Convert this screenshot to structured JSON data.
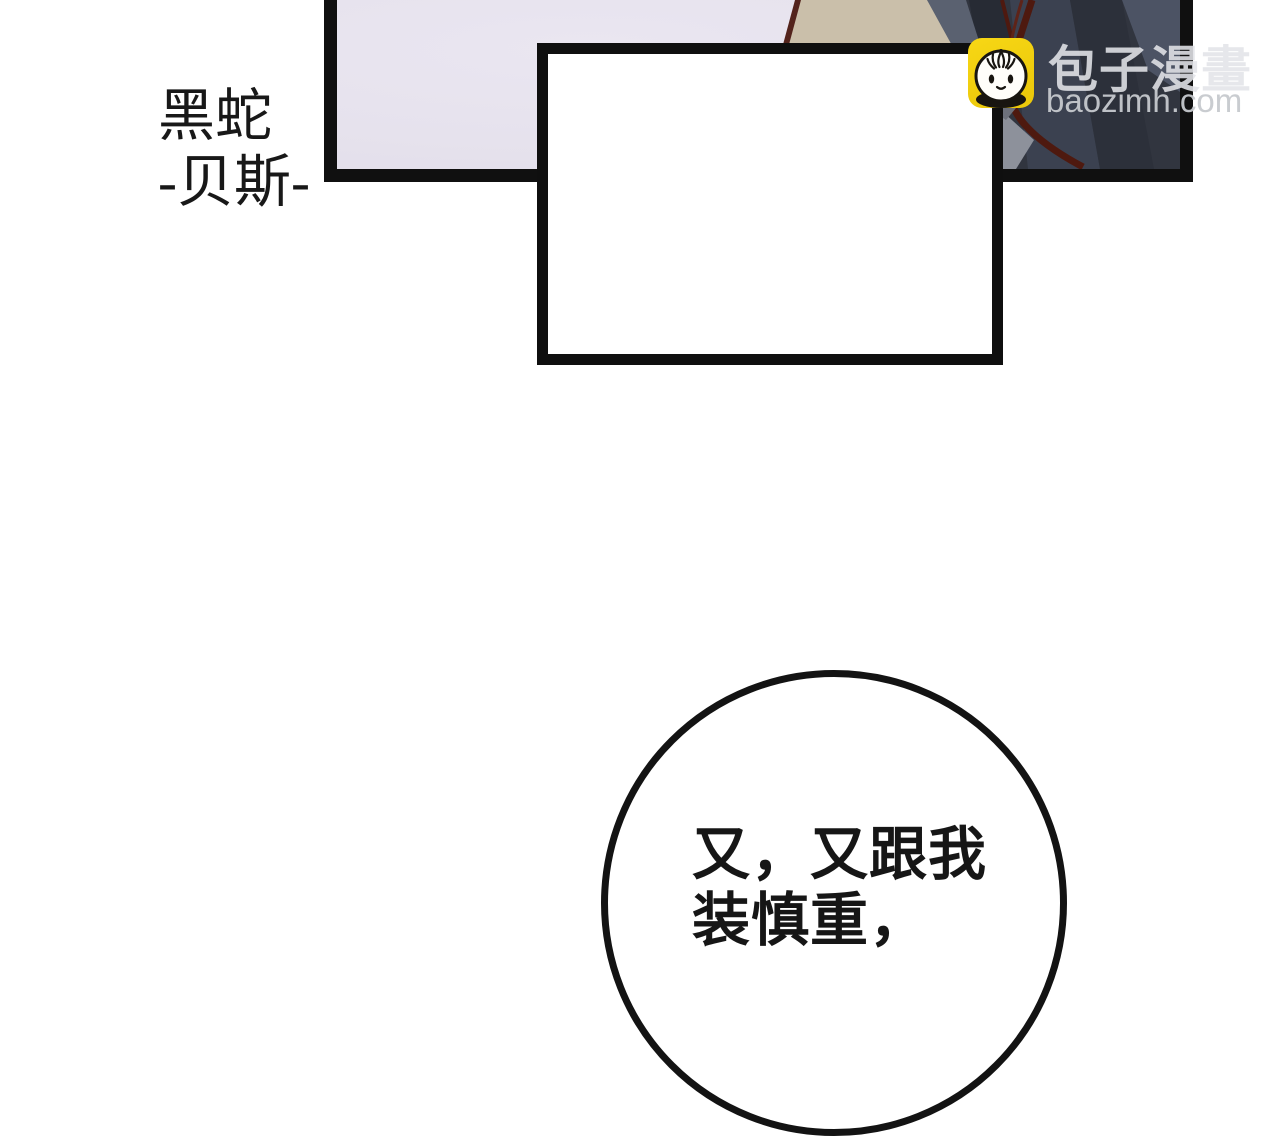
{
  "caption_box": {
    "line1": "黑蛇",
    "line2": "-贝斯-"
  },
  "watermark": {
    "logo_icon": "baozi-bun-icon",
    "brand": "包子漫畫",
    "domain": "baozimh.com"
  },
  "speech_bubble": {
    "line1": "又，又跟我",
    "line2": "装慎重，"
  },
  "colors": {
    "panel_background": "#e6e2ed",
    "panel_border": "#101010",
    "art_beige": "#cabfaa",
    "art_dark_slate": "#31353f",
    "art_maroon": "#4e190f",
    "logo_yellow": "#f4d00f",
    "watermark_text": "#d7d9dc",
    "text_black": "#181818"
  }
}
